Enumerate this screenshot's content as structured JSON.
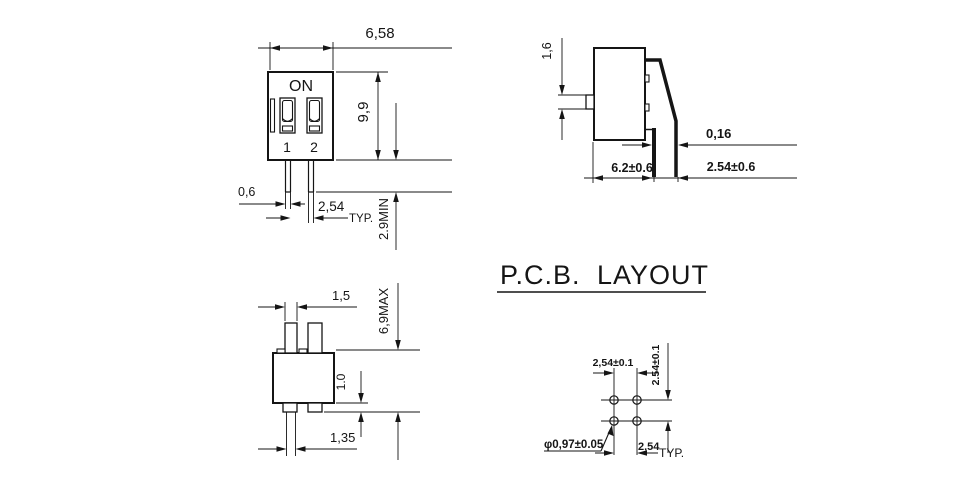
{
  "drawing": {
    "front_view": {
      "on_label": "ON",
      "switch_1": "1",
      "switch_2": "2",
      "width": "6,58",
      "height": "9,9",
      "pin_width": "0,6",
      "pin_pitch": "2,54",
      "pin_pitch_typ": "TYP.",
      "pin_length_min": "2.9MIN"
    },
    "side_view": {
      "actuator_height": "1,6",
      "pin_thickness": "0,16",
      "body_depth": "6.2±0.6",
      "pin_spread": "2.54±0.6"
    },
    "bottom_view": {
      "pin_width": "1,5",
      "overall_depth_max": "6,9MAX",
      "standoff_height": "1.0",
      "pin_base_width": "1,35"
    },
    "pcb_layout": {
      "title_left": "P.C.B.",
      "title_right": "LAYOUT",
      "hole_pitch_h": "2,54±0.1",
      "hole_pitch_v": "2.54±0.1",
      "hole_diameter": "φ0,97±0.05",
      "row_pitch": "2,54",
      "row_pitch_typ": "TYP."
    }
  }
}
